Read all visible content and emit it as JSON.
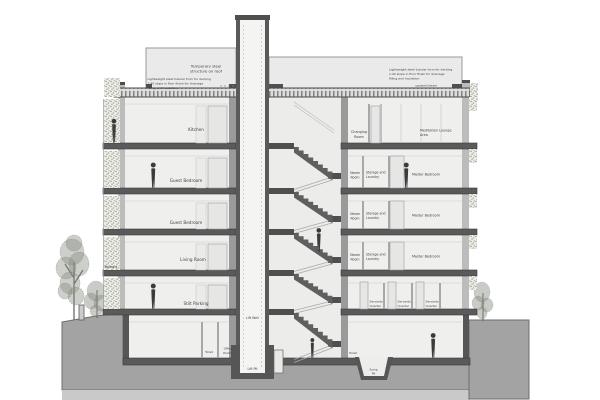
{
  "drawing": {
    "roof": {
      "temporary_structure_lines": [
        "Temporary steel",
        "structure on roof"
      ],
      "deck_note_lines": [
        "Lightweight steel tubular form for decking",
        "1:40 slope in floor finish for drainage",
        "filling and insulation"
      ],
      "upstand_beam_label": "upstand beam"
    },
    "left_wing": {
      "floor_labels": [
        "Kitchen",
        "Guest Bedroom",
        "Guest Bedroom",
        "Living Room",
        "Stilt Parking"
      ],
      "balcony_label": "Balcony",
      "basement": {
        "toilet_label": "Toilet",
        "office_pantry_lines": [
          "Office",
          "Pantry"
        ]
      }
    },
    "core": {
      "lift_well_label": "Lift Well",
      "lift_pit_label": "Lift Pit"
    },
    "right_wing": {
      "top_floor": {
        "changing_room_lines": [
          "Changing",
          "Room"
        ],
        "meditation_lines": [
          "Meditation Lounge",
          "Area"
        ]
      },
      "typical_floor": {
        "steam_lines": [
          "Steam",
          "Room"
        ],
        "storage_lines": [
          "Storage and",
          "Laundry"
        ],
        "master_label": "Master Bedroom"
      },
      "servants_lines": [
        "Servants",
        "Quarter"
      ],
      "basement": {
        "toilet_label": "Toilet",
        "sump_pit_lines": [
          "Sump",
          "Pit"
        ]
      }
    }
  }
}
